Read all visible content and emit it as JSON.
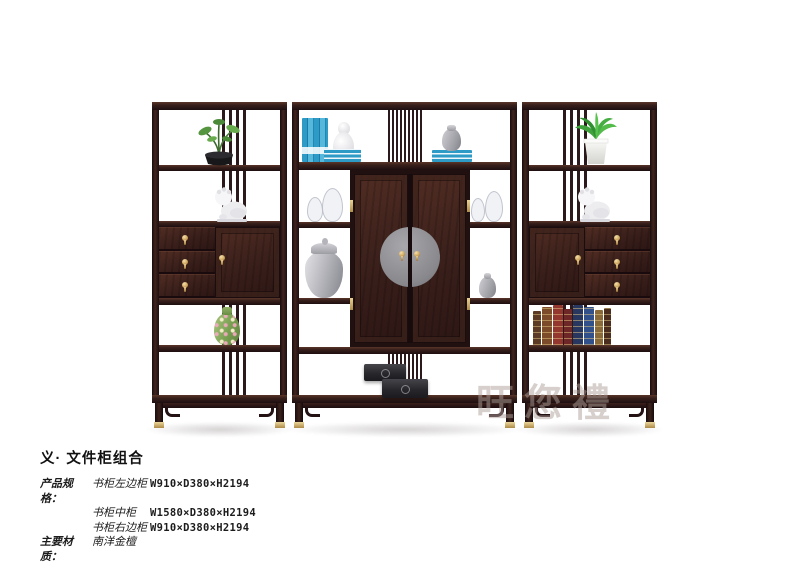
{
  "page": {
    "background_color": "#ffffff"
  },
  "header": {
    "title": "义· 文件柜组合"
  },
  "specs": {
    "label": "产品规格：",
    "rows": [
      {
        "name": "书柜左边柜",
        "size": "W910×D380×H2194"
      },
      {
        "name": "书柜中柜",
        "size": "W1580×D380×H2194"
      },
      {
        "name": "书柜右边柜",
        "size": "W910×D380×H2194"
      }
    ]
  },
  "material": {
    "label": "主要材质：",
    "value": "南洋金檀"
  },
  "watermark": {
    "text": "旺您禮"
  },
  "photo": {
    "colors": {
      "wood_dark": "#241215",
      "wood_panel": "#46261f",
      "brass": "#cfa75f",
      "door_plate": "#95959a",
      "book_blue": "#2e9ac6",
      "vase_green": "#79a052"
    }
  }
}
